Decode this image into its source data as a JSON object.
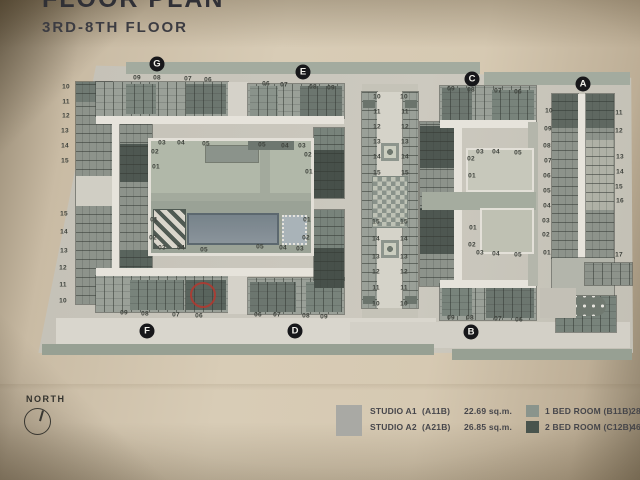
{
  "title": {
    "main_partial": "FLOOR PLAN",
    "sub": "3RD-8TH FLOOR"
  },
  "north_label": "NORTH",
  "legend": {
    "swatches": {
      "studio": "#a9a9a4",
      "bed1": "#8a948c",
      "bed2": "#49544d"
    },
    "rows_left": [
      {
        "name": "STUDIO A1",
        "code": "(A11B)",
        "area": "22.69 sq.m."
      },
      {
        "name": "STUDIO A2",
        "code": "(A21B)",
        "area": "26.85 sq.m."
      }
    ],
    "rows_right": [
      {
        "name": "1 BED ROOM (B11B)",
        "area": "28.86"
      },
      {
        "name": "2 BED ROOM (C12B)",
        "area": "46.24"
      }
    ]
  },
  "plan": {
    "section_badges": [
      {
        "t": "G",
        "x": 157,
        "y": 64
      },
      {
        "t": "E",
        "x": 303,
        "y": 72
      },
      {
        "t": "C",
        "x": 472,
        "y": 79
      },
      {
        "t": "A",
        "x": 583,
        "y": 84
      },
      {
        "t": "F",
        "x": 147,
        "y": 331
      },
      {
        "t": "D",
        "x": 295,
        "y": 331
      },
      {
        "t": "B",
        "x": 471,
        "y": 332
      }
    ],
    "annotation_circle": {
      "x": 190,
      "y": 282,
      "d": 22,
      "color": "#b5372e"
    },
    "unit_numbers": [
      {
        "t": "09",
        "x": 137,
        "y": 78
      },
      {
        "t": "08",
        "x": 157,
        "y": 78
      },
      {
        "t": "07",
        "x": 188,
        "y": 79
      },
      {
        "t": "06",
        "x": 208,
        "y": 80
      },
      {
        "t": "06",
        "x": 266,
        "y": 84
      },
      {
        "t": "07",
        "x": 284,
        "y": 85
      },
      {
        "t": "08",
        "x": 313,
        "y": 87
      },
      {
        "t": "09",
        "x": 331,
        "y": 88
      },
      {
        "t": "09",
        "x": 451,
        "y": 89
      },
      {
        "t": "08",
        "x": 471,
        "y": 90
      },
      {
        "t": "07",
        "x": 498,
        "y": 91
      },
      {
        "t": "06",
        "x": 518,
        "y": 92
      },
      {
        "t": "09",
        "x": 124,
        "y": 313
      },
      {
        "t": "08",
        "x": 145,
        "y": 314
      },
      {
        "t": "07",
        "x": 176,
        "y": 315
      },
      {
        "t": "06",
        "x": 199,
        "y": 316
      },
      {
        "t": "06",
        "x": 258,
        "y": 315
      },
      {
        "t": "07",
        "x": 277,
        "y": 315
      },
      {
        "t": "08",
        "x": 306,
        "y": 316
      },
      {
        "t": "09",
        "x": 324,
        "y": 317
      },
      {
        "t": "09",
        "x": 451,
        "y": 318
      },
      {
        "t": "08",
        "x": 470,
        "y": 318
      },
      {
        "t": "07",
        "x": 498,
        "y": 319
      },
      {
        "t": "06",
        "x": 519,
        "y": 320
      },
      {
        "t": "10",
        "x": 66,
        "y": 87
      },
      {
        "t": "11",
        "x": 66,
        "y": 102
      },
      {
        "t": "12",
        "x": 66,
        "y": 116
      },
      {
        "t": "13",
        "x": 65,
        "y": 131
      },
      {
        "t": "14",
        "x": 65,
        "y": 146
      },
      {
        "t": "15",
        "x": 65,
        "y": 161
      },
      {
        "t": "15",
        "x": 64,
        "y": 214
      },
      {
        "t": "14",
        "x": 64,
        "y": 232
      },
      {
        "t": "13",
        "x": 64,
        "y": 251
      },
      {
        "t": "12",
        "x": 63,
        "y": 268
      },
      {
        "t": "11",
        "x": 63,
        "y": 285
      },
      {
        "t": "10",
        "x": 63,
        "y": 301
      },
      {
        "t": "03",
        "x": 162,
        "y": 143
      },
      {
        "t": "04",
        "x": 181,
        "y": 143
      },
      {
        "t": "05",
        "x": 206,
        "y": 144
      },
      {
        "t": "05",
        "x": 262,
        "y": 145
      },
      {
        "t": "04",
        "x": 285,
        "y": 146
      },
      {
        "t": "03",
        "x": 302,
        "y": 146
      },
      {
        "t": "02",
        "x": 155,
        "y": 152
      },
      {
        "t": "01",
        "x": 156,
        "y": 167
      },
      {
        "t": "01",
        "x": 154,
        "y": 220
      },
      {
        "t": "02",
        "x": 153,
        "y": 238
      },
      {
        "t": "02",
        "x": 308,
        "y": 155
      },
      {
        "t": "01",
        "x": 309,
        "y": 172
      },
      {
        "t": "01",
        "x": 307,
        "y": 220
      },
      {
        "t": "02",
        "x": 306,
        "y": 238
      },
      {
        "t": "03",
        "x": 162,
        "y": 248
      },
      {
        "t": "04",
        "x": 181,
        "y": 248
      },
      {
        "t": "05",
        "x": 204,
        "y": 250
      },
      {
        "t": "05",
        "x": 260,
        "y": 247
      },
      {
        "t": "04",
        "x": 283,
        "y": 248
      },
      {
        "t": "03",
        "x": 300,
        "y": 249
      },
      {
        "t": "10",
        "x": 377,
        "y": 97
      },
      {
        "t": "11",
        "x": 377,
        "y": 112
      },
      {
        "t": "12",
        "x": 377,
        "y": 127
      },
      {
        "t": "13",
        "x": 377,
        "y": 142
      },
      {
        "t": "14",
        "x": 377,
        "y": 157
      },
      {
        "t": "15",
        "x": 377,
        "y": 173
      },
      {
        "t": "15",
        "x": 376,
        "y": 222
      },
      {
        "t": "14",
        "x": 376,
        "y": 239
      },
      {
        "t": "13",
        "x": 376,
        "y": 257
      },
      {
        "t": "12",
        "x": 376,
        "y": 272
      },
      {
        "t": "11",
        "x": 376,
        "y": 288
      },
      {
        "t": "10",
        "x": 376,
        "y": 304
      },
      {
        "t": "10",
        "x": 404,
        "y": 97
      },
      {
        "t": "11",
        "x": 405,
        "y": 112
      },
      {
        "t": "12",
        "x": 405,
        "y": 127
      },
      {
        "t": "13",
        "x": 405,
        "y": 142
      },
      {
        "t": "14",
        "x": 405,
        "y": 157
      },
      {
        "t": "15",
        "x": 405,
        "y": 173
      },
      {
        "t": "15",
        "x": 404,
        "y": 222
      },
      {
        "t": "14",
        "x": 404,
        "y": 239
      },
      {
        "t": "13",
        "x": 404,
        "y": 257
      },
      {
        "t": "12",
        "x": 404,
        "y": 272
      },
      {
        "t": "11",
        "x": 404,
        "y": 288
      },
      {
        "t": "10",
        "x": 404,
        "y": 304
      },
      {
        "t": "03",
        "x": 480,
        "y": 152
      },
      {
        "t": "04",
        "x": 496,
        "y": 152
      },
      {
        "t": "05",
        "x": 518,
        "y": 153
      },
      {
        "t": "02",
        "x": 471,
        "y": 159
      },
      {
        "t": "01",
        "x": 472,
        "y": 176
      },
      {
        "t": "01",
        "x": 473,
        "y": 228
      },
      {
        "t": "02",
        "x": 472,
        "y": 245
      },
      {
        "t": "03",
        "x": 480,
        "y": 253
      },
      {
        "t": "04",
        "x": 496,
        "y": 254
      },
      {
        "t": "05",
        "x": 518,
        "y": 255
      },
      {
        "t": "10",
        "x": 549,
        "y": 111
      },
      {
        "t": "09",
        "x": 548,
        "y": 129
      },
      {
        "t": "08",
        "x": 547,
        "y": 146
      },
      {
        "t": "07",
        "x": 548,
        "y": 161
      },
      {
        "t": "06",
        "x": 547,
        "y": 176
      },
      {
        "t": "05",
        "x": 547,
        "y": 191
      },
      {
        "t": "04",
        "x": 547,
        "y": 206
      },
      {
        "t": "03",
        "x": 546,
        "y": 221
      },
      {
        "t": "02",
        "x": 546,
        "y": 235
      },
      {
        "t": "01",
        "x": 547,
        "y": 253
      },
      {
        "t": "11",
        "x": 619,
        "y": 113
      },
      {
        "t": "12",
        "x": 619,
        "y": 131
      },
      {
        "t": "13",
        "x": 620,
        "y": 157
      },
      {
        "t": "14",
        "x": 620,
        "y": 172
      },
      {
        "t": "15",
        "x": 619,
        "y": 187
      },
      {
        "t": "16",
        "x": 620,
        "y": 201
      },
      {
        "t": "17",
        "x": 619,
        "y": 255
      }
    ]
  }
}
